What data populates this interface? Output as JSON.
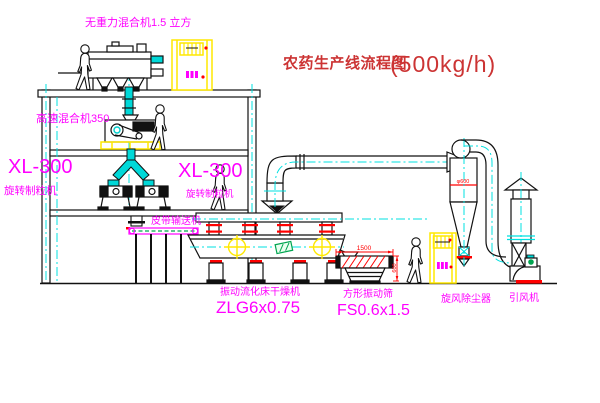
{
  "title": {
    "text": "农药生产线流程图",
    "capacity": "(500kg/h)"
  },
  "equipment": {
    "gravity_mixer": {
      "label": "无重力混合机1.5 立方"
    },
    "high_speed_mixer": {
      "label": "高速混合机350"
    },
    "granulator_left": {
      "model": "XL-300",
      "name": "旋转制粒机"
    },
    "granulator_right": {
      "model": "XL-300",
      "name": "旋转制粒机"
    },
    "belt_conveyor": {
      "label": "皮带输送机"
    },
    "fluid_bed_dryer": {
      "name": "振动流化床干燥机",
      "model": "ZLG6x0.75"
    },
    "vibrating_screen": {
      "name": "方形振动筛",
      "model": "FS0.6x1.5",
      "length_dim": "1500",
      "height_dim": "600"
    },
    "cyclone": {
      "label": "旋风除尘器",
      "diameter_dim": "φ600"
    },
    "fan": {
      "label": "引风机"
    }
  },
  "colors": {
    "title_red": "#cc3434",
    "label_magenta": "#ff00ff",
    "dimension_red": "#ff0000",
    "centerline_cyan": "#00e0e0",
    "cabinet_yellow": "#ffe800",
    "accent_green": "#00a550",
    "outline_black": "#111111"
  }
}
